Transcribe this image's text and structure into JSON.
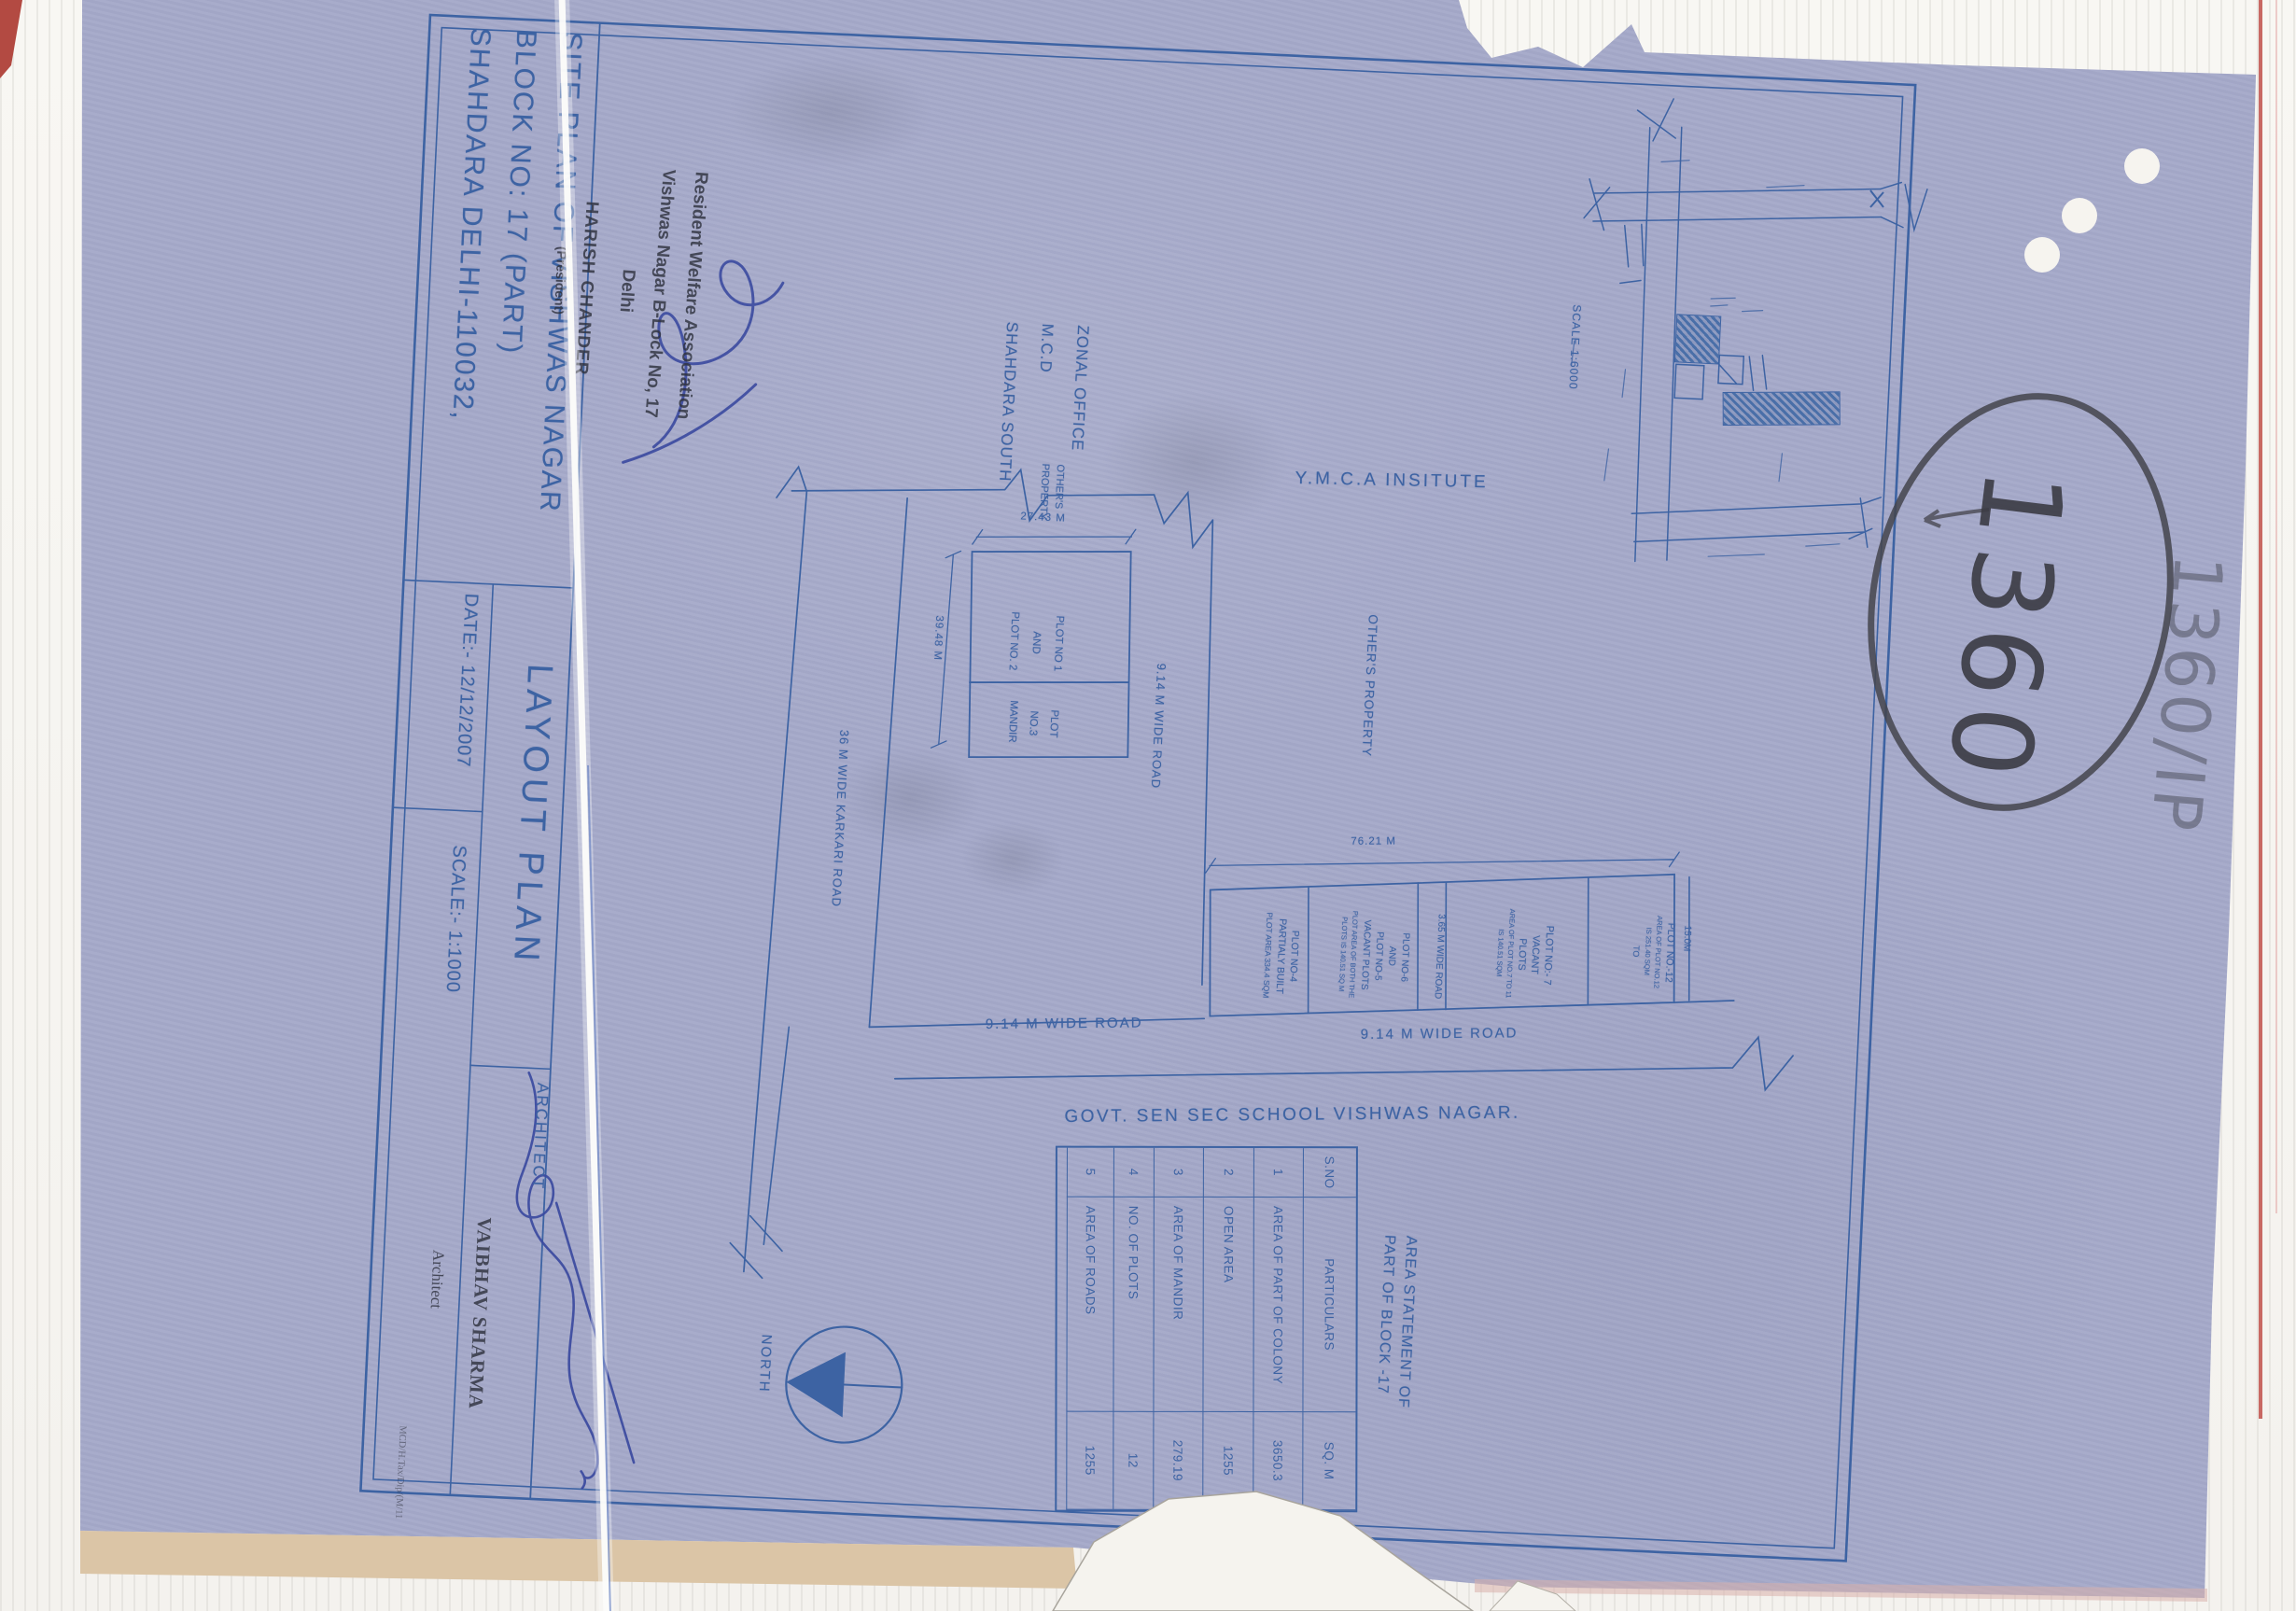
{
  "colors": {
    "paper": "#a5a9c9",
    "drawing_ink": "#3d63a3",
    "stamp_ink": "#30333f",
    "pencil": "#42424a",
    "signature_ink": "#3b4aa0",
    "scanner_background": "#f7f6f2",
    "paper_edge_tan": "#dbc5a6"
  },
  "annotations": {
    "circled_number": "1360",
    "corner_note": "1360/IP"
  },
  "title_block": {
    "title_line1": "SITE PLAN OF VISHWAS NAGAR",
    "title_line2": "BLOCK NO: 17 (PART)",
    "title_line3": "SHAHDARA DELHI-110032,",
    "date": "DATE:- 12/12/2007",
    "plan_type": "LAYOUT PLAN",
    "scale": "SCALE:- 1:1000",
    "architect_label": "ARCHITECT"
  },
  "stamps": {
    "association_line1": "Resident Welfare Association",
    "association_line2": "Vishwas Nagar B-Lock No, 17",
    "association_line3": "Delhi",
    "president_name": "HARISH CHANDER",
    "president_title": "(President)",
    "architect_name": "VAIBHAV SHARMA",
    "architect_title": "Architect",
    "architect_reg": "MCD/H.Tax/Dip/(M/11"
  },
  "plan": {
    "zonal_line1": "ZONAL OFFICE",
    "zonal_line2": "M.C.D",
    "zonal_line3": "SHAHDARA SOUTH",
    "ymca": "Y.M.C.A INSITUTE",
    "others_property_sm1": "OTHER'S",
    "others_property_sm2": "PROPERTY",
    "others_property": "OTHER'S PROPERTY",
    "karkari_road": "36 M WIDE KARKARI ROAD",
    "road_914_vertical": "9.14 M WIDE ROAD",
    "road_914_left": "9.14 M WIDE ROAD",
    "road_914_right": "9.14 M WIDE ROAD",
    "road_365": "3.65 M WIDE ROAD",
    "school": "GOVT. SEN SEC SCHOOL VISHWAS NAGAR.",
    "north_label": "NORTH",
    "dim_plot_top": "27.43 M",
    "dim_plot_side": "39.48 M",
    "dim_band": "76.21 M",
    "dim_right": "15.0M",
    "plot12_1": "PLOT NO 1",
    "plot12_2": "AND",
    "plot12_3": "PLOT NO. 2",
    "mandir_1": "PLOT",
    "mandir_2": "NO.3",
    "mandir_3": "MANDIR",
    "cell4_1": "PLOT NO-4",
    "cell4_2": "PARTIALY BUILT",
    "cell4_3": "PLOT AREA 334.4 SQM",
    "cell56_1": "PLOT NO-6",
    "cell56_2": "AND",
    "cell56_3": "PLOT NO-5",
    "cell56_4": "VACANT PLOTS",
    "cell56_5": "PLOT AREA OF BOTH THE",
    "cell56_6": "PLOTS IS 140.51 SQ M",
    "cell7_1": "PLOT NO:- 7",
    "cell7_2": "VACANT",
    "cell7_3": "PLOTS",
    "cell7_4": "AREA OF PLOT NO.7 TO 11",
    "cell7_5": "IS 140.51 SQM",
    "cell12_1": "PLOT NO.-12",
    "cell12_2": "AREA OF PLOT NO.12",
    "cell12_3": "IS 251.40 SQM",
    "cell12_4": "TO",
    "inset_scale": "SCALE 1:6000"
  },
  "area_table": {
    "title_line1": "AREA STATEMENT OF",
    "title_line2": "PART OF BLOCK -17",
    "h_sno": "S.NO",
    "h_part": "PARTICULARS",
    "h_sqm": "SQ. M",
    "rows": [
      {
        "no": "1",
        "particulars": "AREA OF PART OF COLONY",
        "value": "3650.3"
      },
      {
        "no": "2",
        "particulars": "OPEN AREA",
        "value": "1255"
      },
      {
        "no": "3",
        "particulars": "AREA OF MANDIR",
        "value": "279.19"
      },
      {
        "no": "4",
        "particulars": "NO. OF PLOTS",
        "value": "12"
      },
      {
        "no": "5",
        "particulars": "AREA OF ROADS",
        "value": "1255"
      }
    ]
  }
}
